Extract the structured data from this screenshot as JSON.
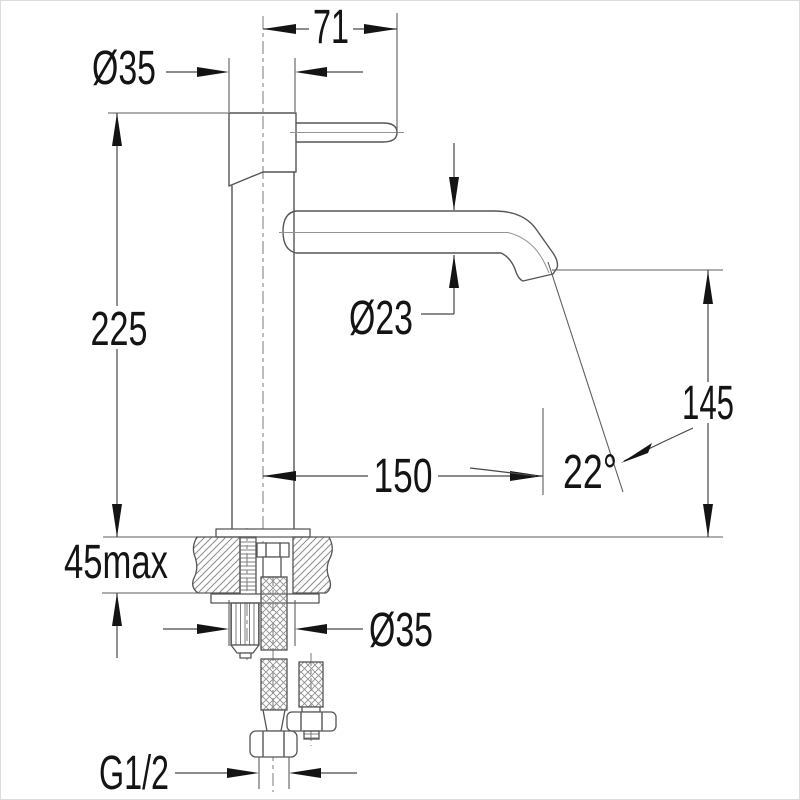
{
  "drawing": {
    "kind": "basin-mixer-installation-diagram"
  },
  "colors": {
    "background": "#ffffff",
    "outline": "#555555",
    "dimension_line": "#474747",
    "annotation_text": "#141414",
    "hatch": "#8c8c8c"
  },
  "dimensions": {
    "handle_length": "71",
    "body_diameter": "Ø35",
    "overall_height": "225",
    "spout_diameter": "Ø23",
    "spout_reach": "150",
    "spout_angle": "22°",
    "outlet_height": "145",
    "max_deck_thickness": "45max",
    "mounting_hole_diameter": "Ø35",
    "thread_size": "G1/2"
  }
}
